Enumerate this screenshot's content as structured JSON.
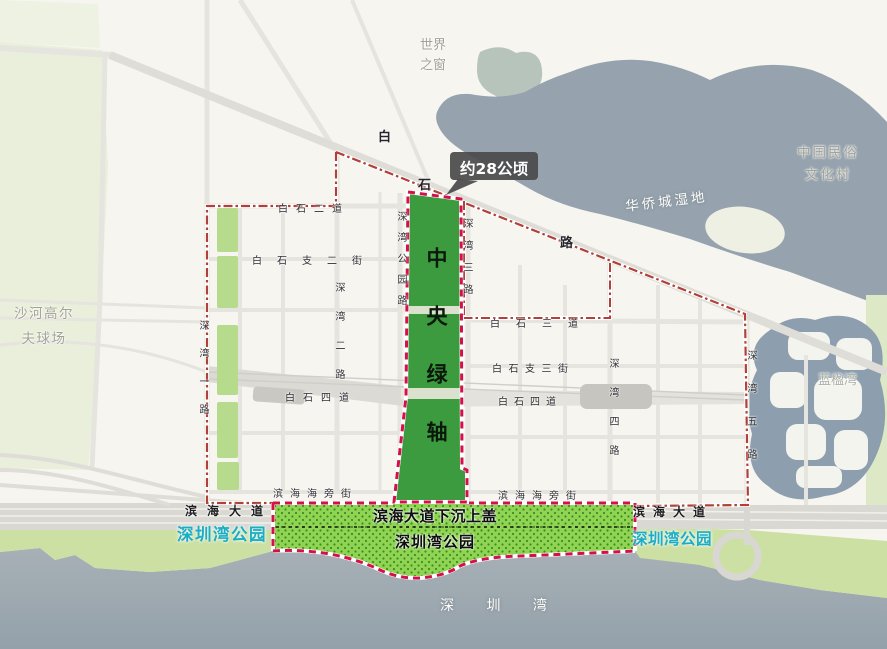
{
  "map": {
    "tooltip": {
      "text": "约28公顷"
    },
    "axis": {
      "label": "中央绿轴"
    },
    "areas": {
      "world_window": "世界之窗",
      "folk_village": "中国民俗文化村",
      "oct_wetland": "华侨城湿地",
      "golf": "沙河高尔夫球场",
      "blue_bay": "蓝楹湾",
      "shenzhen_bay": "深 圳 湾"
    },
    "parks": {
      "cover": "滨海大道下沉上盖",
      "center": "深圳湾公园",
      "west": "深圳湾公园",
      "east": "深圳湾公园"
    },
    "roads": {
      "baishi": "白石路",
      "baishi2": "白石二道",
      "baishi_zhi2": "白石支二街",
      "baishi3": "白石三道",
      "baishi_zhi3": "白石支三街",
      "baishi4_w": "白石四道",
      "baishi4_e": "白石四道",
      "binhai_haipang_w": "滨海海旁街",
      "binhai_haipang_e": "滨海海旁街",
      "shenwan1": "深湾一路",
      "shenwan2": "深湾二路",
      "shenwan_park": "深湾公园路",
      "shenwan3": "深湾三路",
      "shenwan4": "深湾四路",
      "shenwan5": "深湾五路",
      "binhai_blvd_w": "滨海大道",
      "binhai_blvd_e": "滨海大道"
    },
    "colors": {
      "axis_green": "#3b9b3e",
      "park_green": "#8fd452",
      "park_border_red": "#d4104a",
      "boundary_red": "#b04038",
      "park_label_cyan": "#1badc4",
      "water_gray": "#96a3ae"
    }
  }
}
